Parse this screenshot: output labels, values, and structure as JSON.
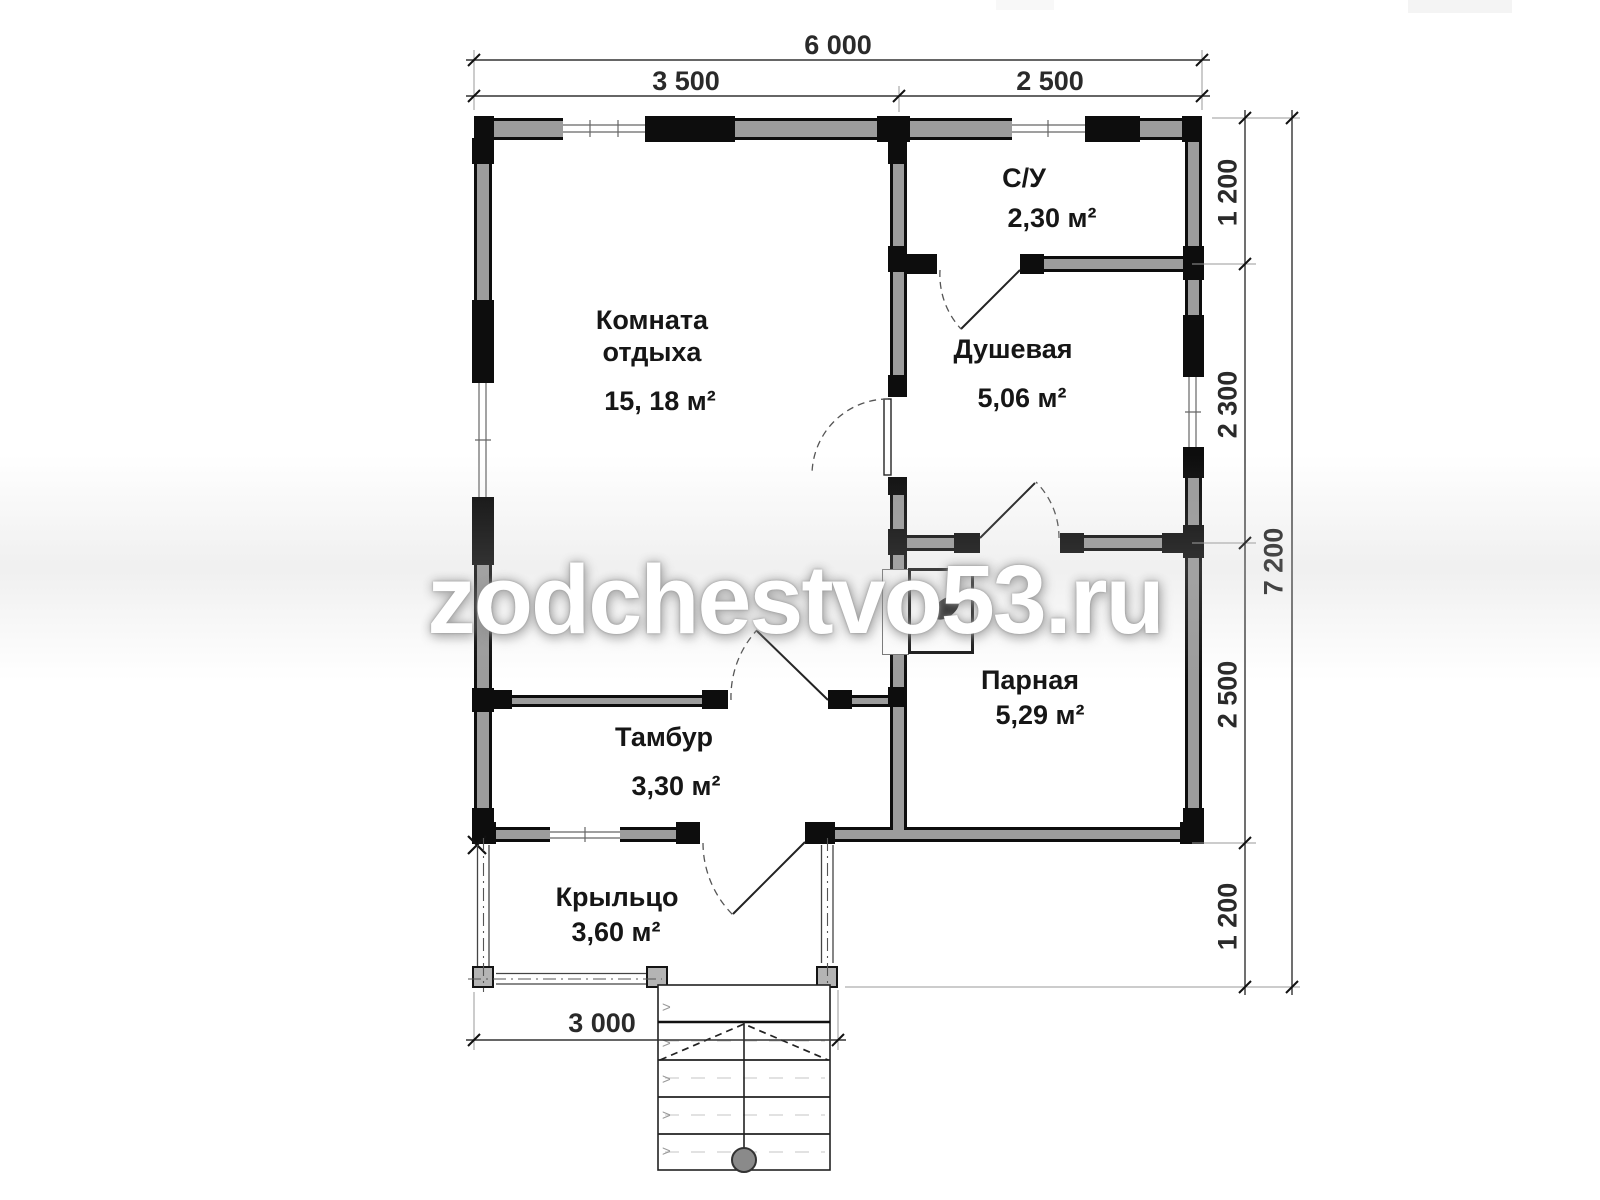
{
  "watermark": {
    "text": "zodchestvo53.ru"
  },
  "rooms": {
    "rest": {
      "name": "Комната отдыха",
      "area": "15, 18 м²"
    },
    "wc": {
      "name": "С/У",
      "area": "2,30 м²"
    },
    "shower": {
      "name": "Душевая",
      "area": "5,06 м²"
    },
    "steam": {
      "name": "Парная",
      "area": "5,29 м²"
    },
    "vestibule": {
      "name": "Тамбур",
      "area": "3,30 м²"
    },
    "porch": {
      "name": "Крыльцо",
      "area": "3,60 м²"
    }
  },
  "dimensions": {
    "overall_width": "6 000",
    "span_left": "3 500",
    "span_right": "2 500",
    "right_segments": [
      "1 200",
      "2 300",
      "2 500",
      "1 200"
    ],
    "overall_height": "7 200",
    "porch_width": "3 000"
  },
  "colors": {
    "wall_fill": "#9c9c9c",
    "wall_line": "#0d0d0d",
    "dim_text": "#2a2a2a"
  }
}
